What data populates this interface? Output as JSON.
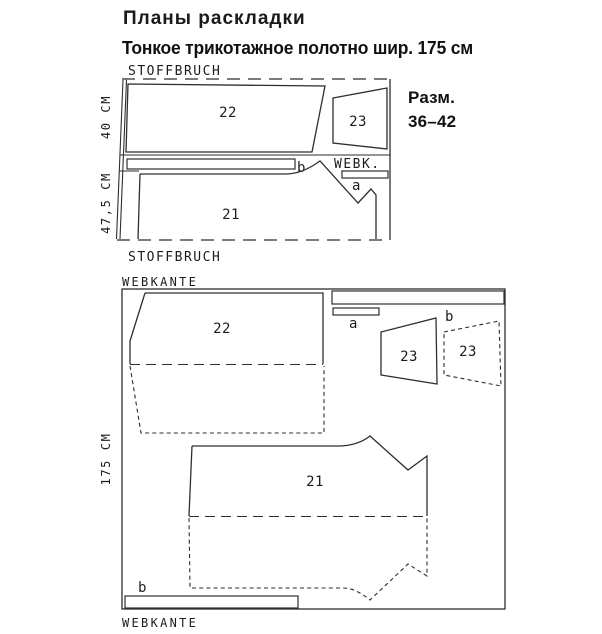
{
  "header": {
    "title": "Планы раскладки",
    "subtitle": "Тонкое трикотажное полотно шир. 175 см"
  },
  "size_note": {
    "line1": "Разм.",
    "line2": "36–42"
  },
  "layout1": {
    "fold_top": "STOFFBRUCH",
    "fold_bottom": "STOFFBRUCH",
    "height_top": "40 CM",
    "height_bottom": "47,5 CM",
    "selvage": "WEBK.",
    "piece_22": "22",
    "piece_23": "23",
    "piece_21": "21",
    "strip_b": "b",
    "strip_a": "a"
  },
  "layout2": {
    "selvage_top": "WEBKANTE",
    "selvage_bottom": "WEBKANTE",
    "fabric_width": "175 CM",
    "piece_22": "22",
    "piece_23": "23",
    "piece_23_mirror": "23",
    "piece_21": "21",
    "strip_a": "a",
    "strip_b_top": "b",
    "strip_b_bottom": "b"
  }
}
